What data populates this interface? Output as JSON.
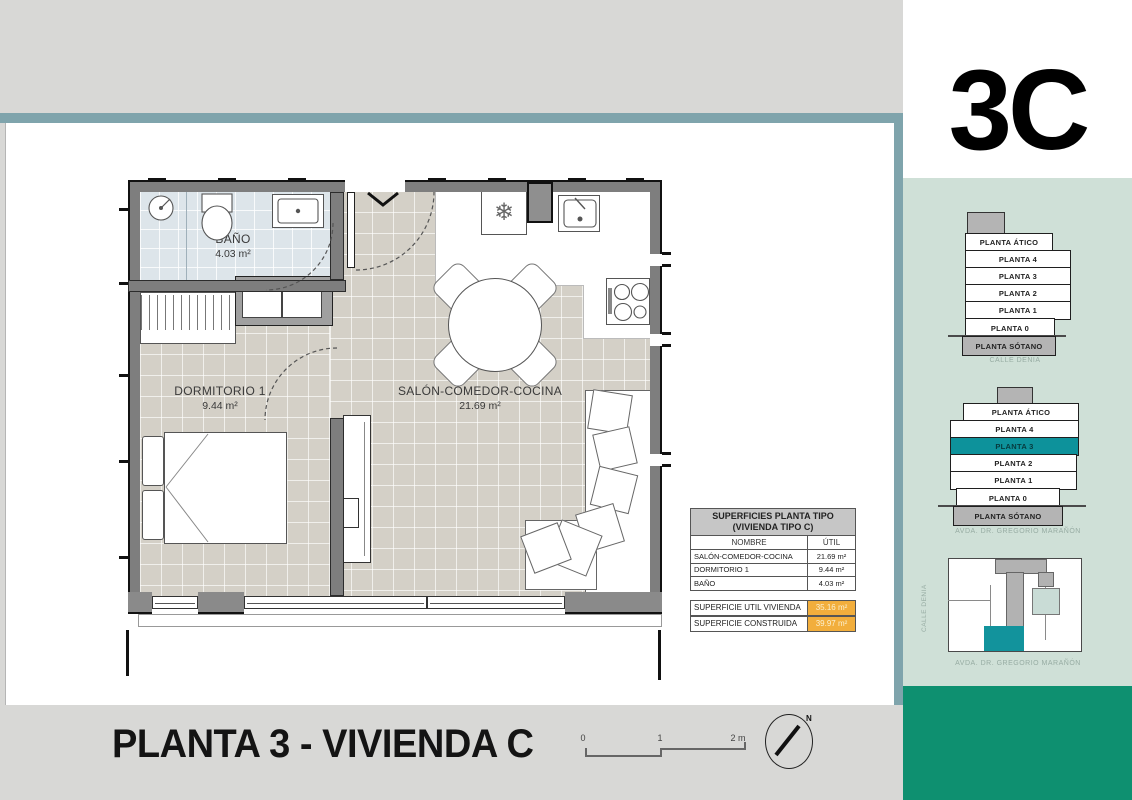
{
  "unit_label": "3C",
  "icons": {
    "fridge_snowflake": "❄"
  },
  "plan": {
    "rooms": {
      "bano": {
        "name": "BAÑO",
        "area": "4.03 m²"
      },
      "dormitorio": {
        "name": "DORMITORIO 1",
        "area": "9.44 m²"
      },
      "salon": {
        "name": "SALÓN-COMEDOR-COCINA",
        "area": "21.69 m²"
      }
    }
  },
  "surfaces_table": {
    "title_line1": "SUPERFICIES PLANTA TIPO",
    "title_line2": "(VIVIENDA TIPO C)",
    "columns": {
      "name": "NOMBRE",
      "util": "ÚTIL"
    },
    "rows": [
      {
        "name": "SALÓN-COMEDOR-COCINA",
        "util": "21.69 m²"
      },
      {
        "name": "DORMITORIO 1",
        "util": "9.44 m²"
      },
      {
        "name": "BAÑO",
        "util": "4.03 m²"
      }
    ],
    "totals": [
      {
        "name": "SUPERFICIE UTIL VIVIENDA",
        "value": "35.16 m²"
      },
      {
        "name": "SUPERFICIE CONSTRUIDA",
        "value": "39.97 m²"
      }
    ]
  },
  "sidebar": {
    "stack_top": {
      "floors": [
        "PLANTA ÁTICO",
        "PLANTA 4",
        "PLANTA 3",
        "PLANTA 2",
        "PLANTA 1",
        "PLANTA 0",
        "PLANTA SÓTANO"
      ],
      "caption": "CALLE DENIA"
    },
    "stack_bottom": {
      "floors": [
        "PLANTA ÁTICO",
        "PLANTA 4",
        "PLANTA 3",
        "PLANTA 2",
        "PLANTA 1",
        "PLANTA 0",
        "PLANTA SÓTANO"
      ],
      "highlighted_floor": "PLANTA 3",
      "caption": "AVDA. DR. GREGORIO MARAÑÓN"
    },
    "keyplan": {
      "street_left": "CALLE DENIA",
      "street_bottom": "AVDA. DR. GREGORIO MARAÑÓN"
    }
  },
  "footer": {
    "title": "PLANTA 3 - VIVIENDA C",
    "scale_ticks": [
      "0",
      "1",
      "2 m"
    ],
    "north_label": "N"
  },
  "colors": {
    "accent_teal_bar": "#7fa4ac",
    "highlight_teal": "#0d929b",
    "sidebar_green": "#cfe0d7",
    "brand_green": "#0e9070",
    "total_highlight_orange": "#f2ae3c",
    "bath_floor": "#dde5ea",
    "floor_beige": "#d4d0c7"
  }
}
